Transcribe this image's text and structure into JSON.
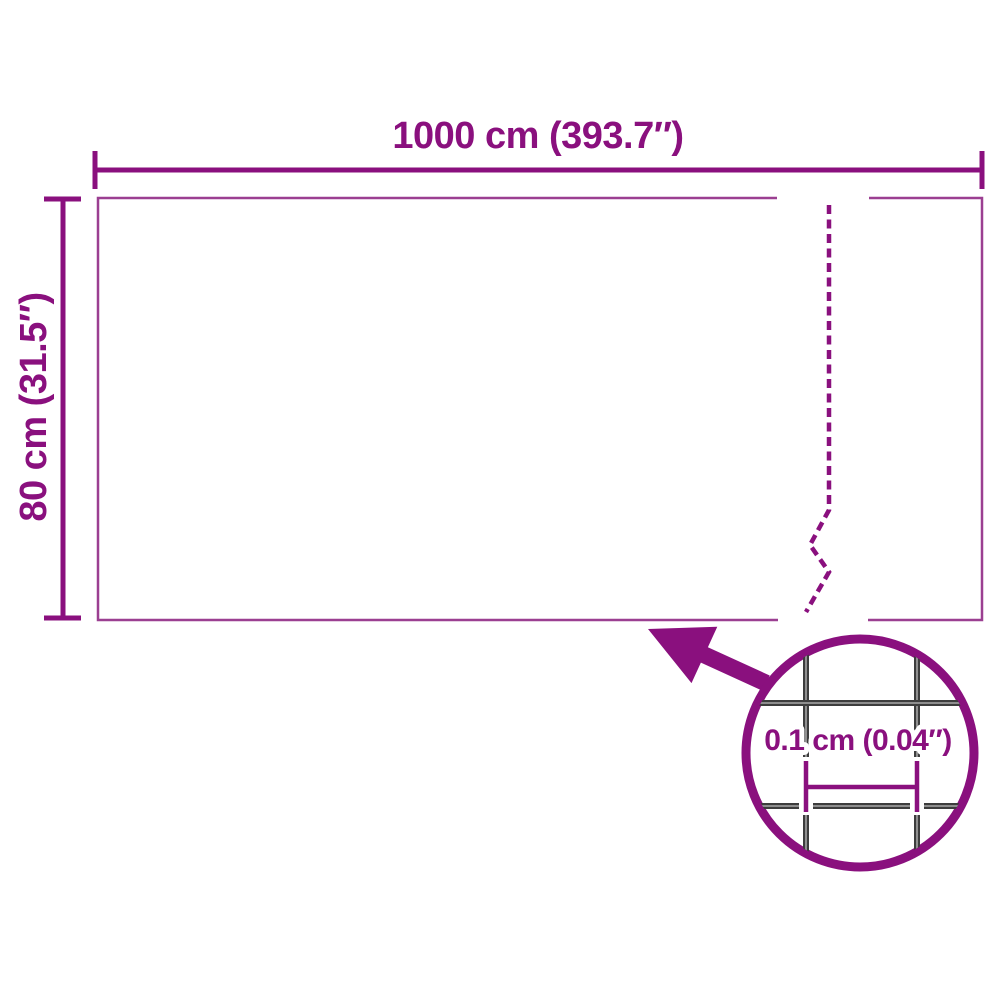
{
  "diagram": {
    "type": "product-dimension-diagram",
    "subject": "mesh-fence-roll",
    "width_label": "1000 cm (393.7″)",
    "height_label": "80 cm (31.5″)",
    "mesh_detail_label": "0.1 cm (0.04″)",
    "colors": {
      "accent_purple": "#8a107e",
      "panel_outline_purple": "#9b3f91",
      "wire_dark_gray": "#3d3d3d",
      "wire_highlight_gray": "#9a9a9a",
      "background": "#ffffff"
    }
  }
}
